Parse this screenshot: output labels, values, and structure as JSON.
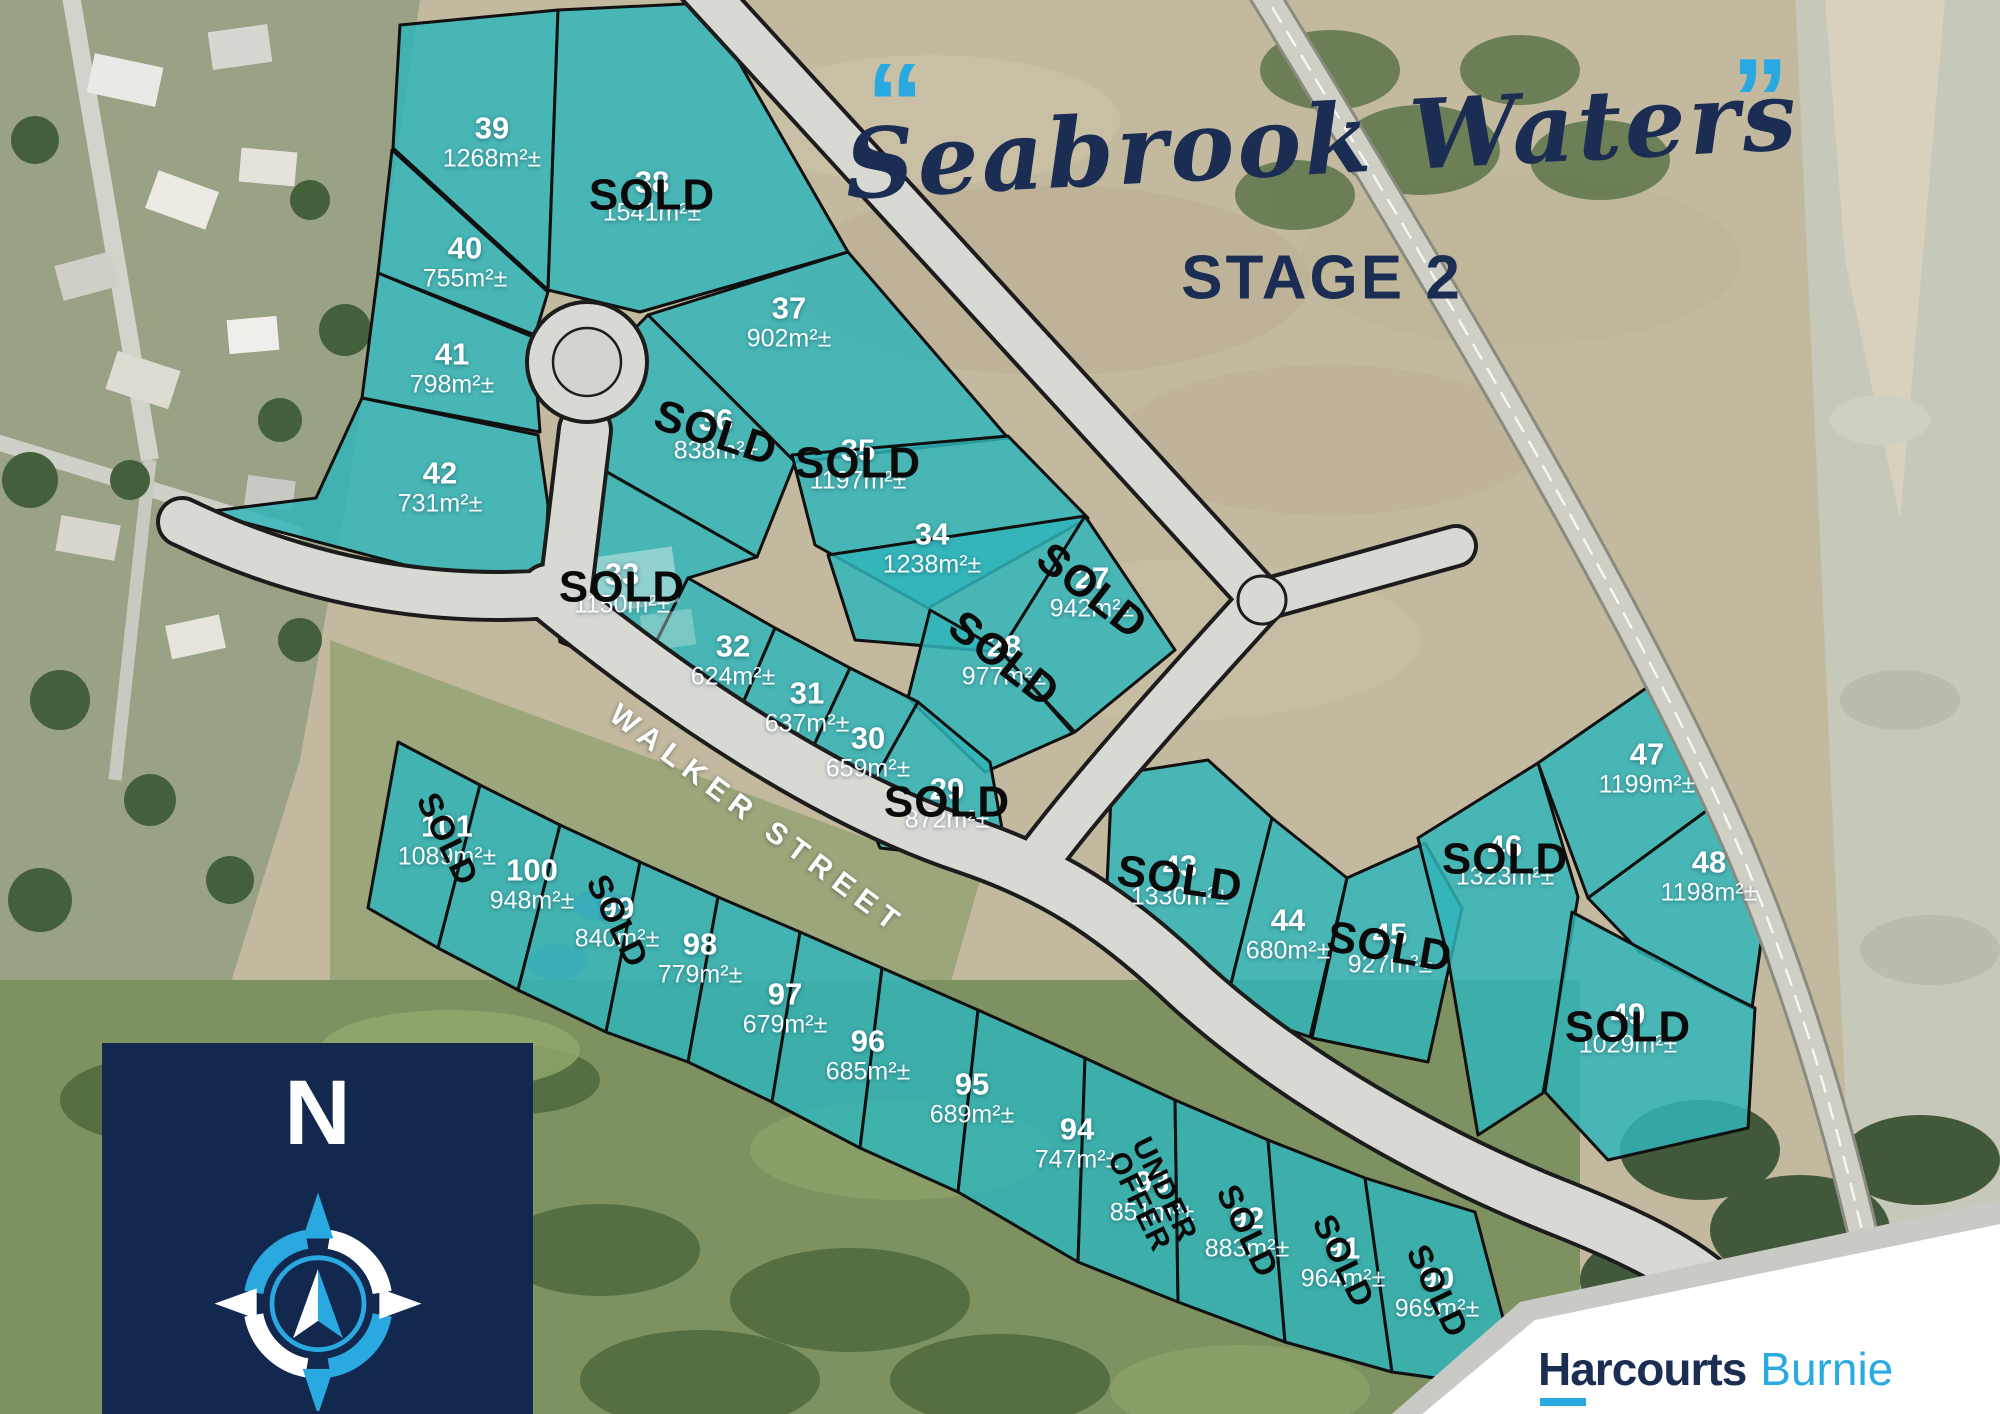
{
  "title": {
    "quote_open": "“",
    "quote_close": "”",
    "name": "Seabrook Waters",
    "stage": "STAGE 2"
  },
  "street_label": "WALKER STREET",
  "compass_label": "N",
  "brand": {
    "agency": "Harcourts",
    "office": "Burnie"
  },
  "status_labels": {
    "sold": "SOLD",
    "under_offer": "UNDER\nOFFER"
  },
  "colors": {
    "navy": "#1b2d52",
    "light_blue": "#29abe2",
    "teal_lot": "#31b5ba",
    "sold_text": "#0a0a0a",
    "lot_text": "#ffffff"
  },
  "lots": [
    {
      "id": "39",
      "size": "1268m²±",
      "status": "available",
      "x": 492,
      "y": 142,
      "rot": 0
    },
    {
      "id": "38",
      "size": "1541m²±",
      "status": "sold",
      "x": 652,
      "y": 196,
      "rot": 0
    },
    {
      "id": "40",
      "size": "755m²±",
      "status": "available",
      "x": 465,
      "y": 262,
      "rot": 0
    },
    {
      "id": "37",
      "size": "902m²±",
      "status": "available",
      "x": 789,
      "y": 322,
      "rot": 0
    },
    {
      "id": "41",
      "size": "798m²±",
      "status": "available",
      "x": 452,
      "y": 368,
      "rot": 0
    },
    {
      "id": "36",
      "size": "838m²±",
      "status": "sold",
      "x": 716,
      "y": 434,
      "rot": 18
    },
    {
      "id": "35",
      "size": "1197m²±",
      "status": "sold",
      "x": 858,
      "y": 464,
      "rot": 0
    },
    {
      "id": "42",
      "size": "731m²±",
      "status": "available",
      "x": 440,
      "y": 487,
      "rot": 0
    },
    {
      "id": "34",
      "size": "1238m²±",
      "status": "available",
      "x": 932,
      "y": 548,
      "rot": 0
    },
    {
      "id": "33",
      "size": "1150m²±",
      "status": "sold",
      "x": 622,
      "y": 588,
      "rot": 0
    },
    {
      "id": "27",
      "size": "942m²±",
      "status": "sold",
      "x": 1092,
      "y": 592,
      "rot": 38
    },
    {
      "id": "32",
      "size": "624m²±",
      "status": "available",
      "x": 733,
      "y": 660,
      "rot": 0
    },
    {
      "id": "28",
      "size": "977m²±",
      "status": "sold",
      "x": 1004,
      "y": 660,
      "rot": 38
    },
    {
      "id": "31",
      "size": "637m²±",
      "status": "available",
      "x": 807,
      "y": 707,
      "rot": 0
    },
    {
      "id": "30",
      "size": "659m²±",
      "status": "available",
      "x": 868,
      "y": 752,
      "rot": 0
    },
    {
      "id": "29",
      "size": "872m²±",
      "status": "sold",
      "x": 947,
      "y": 803,
      "rot": 0
    },
    {
      "id": "101",
      "size": "1089m²±",
      "status": "sold",
      "x": 447,
      "y": 840,
      "rot": 64
    },
    {
      "id": "100",
      "size": "948m²±",
      "status": "available",
      "x": 532,
      "y": 884,
      "rot": 0
    },
    {
      "id": "99",
      "size": "840m²±",
      "status": "sold",
      "x": 617,
      "y": 922,
      "rot": 64
    },
    {
      "id": "98",
      "size": "779m²±",
      "status": "available",
      "x": 700,
      "y": 958,
      "rot": 0
    },
    {
      "id": "97",
      "size": "679m²±",
      "status": "available",
      "x": 785,
      "y": 1008,
      "rot": 0
    },
    {
      "id": "96",
      "size": "685m²±",
      "status": "available",
      "x": 868,
      "y": 1055,
      "rot": 0
    },
    {
      "id": "95",
      "size": "689m²±",
      "status": "available",
      "x": 972,
      "y": 1098,
      "rot": 0
    },
    {
      "id": "94",
      "size": "747m²±",
      "status": "available",
      "x": 1077,
      "y": 1143,
      "rot": 0
    },
    {
      "id": "93",
      "size": "851m²±",
      "status": "under_offer",
      "x": 1152,
      "y": 1196,
      "rot": 64
    },
    {
      "id": "92",
      "size": "883m²±",
      "status": "sold",
      "x": 1247,
      "y": 1232,
      "rot": 64
    },
    {
      "id": "91",
      "size": "964m²±",
      "status": "sold",
      "x": 1343,
      "y": 1262,
      "rot": 64
    },
    {
      "id": "90",
      "size": "969m²±",
      "status": "sold",
      "x": 1437,
      "y": 1292,
      "rot": 64
    },
    {
      "id": "43",
      "size": "1330m²±",
      "status": "sold",
      "x": 1180,
      "y": 880,
      "rot": 8
    },
    {
      "id": "44",
      "size": "680m²±",
      "status": "available",
      "x": 1288,
      "y": 934,
      "rot": 0
    },
    {
      "id": "45",
      "size": "927m²±",
      "status": "sold",
      "x": 1390,
      "y": 948,
      "rot": 10
    },
    {
      "id": "46",
      "size": "1323m²±",
      "status": "sold",
      "x": 1505,
      "y": 860,
      "rot": 0
    },
    {
      "id": "47",
      "size": "1199m²±",
      "status": "available",
      "x": 1647,
      "y": 768,
      "rot": 0
    },
    {
      "id": "48",
      "size": "1198m²±",
      "status": "available",
      "x": 1709,
      "y": 876,
      "rot": 0
    },
    {
      "id": "49",
      "size": "1029m²±",
      "status": "sold",
      "x": 1628,
      "y": 1028,
      "rot": 0
    }
  ]
}
